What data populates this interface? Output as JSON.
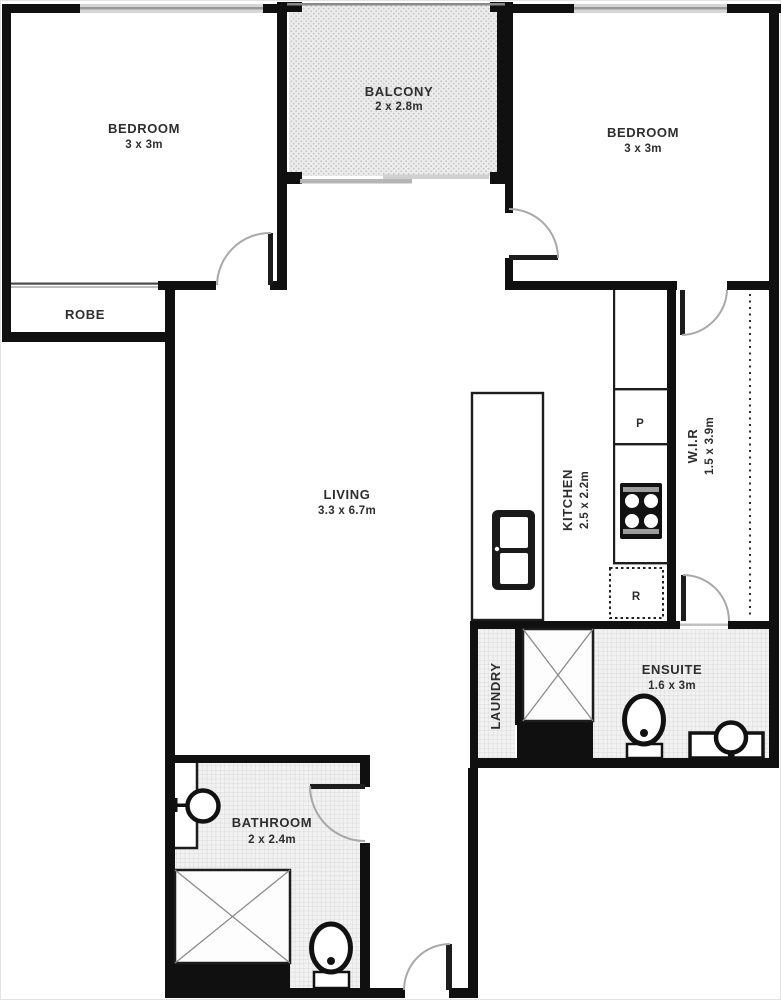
{
  "rooms": {
    "bedroom_left": {
      "name": "BEDROOM",
      "dims": "3 x 3m"
    },
    "bedroom_right": {
      "name": "BEDROOM",
      "dims": "3 x 3m"
    },
    "balcony": {
      "name": "BALCONY",
      "dims": "2 x 2.8m"
    },
    "robe": {
      "name": "ROBE"
    },
    "living": {
      "name": "LIVING",
      "dims": "3.3 x 6.7m"
    },
    "kitchen": {
      "name": "KITCHEN",
      "dims": "2.5 x 2.2m"
    },
    "wir": {
      "name": "W.I.R",
      "dims": "1.5 x 3.9m"
    },
    "laundry": {
      "name": "LAUNDRY"
    },
    "ensuite": {
      "name": "ENSUITE",
      "dims": "1.6 x 3m"
    },
    "bathroom": {
      "name": "BATHROOM",
      "dims": "2 x 2.4m"
    }
  },
  "markers": {
    "pantry": "P",
    "fridge": "R"
  },
  "colors": {
    "wall": "#101010",
    "hatch_bg": "#f2f2f2",
    "hatch_line": "#d9d9d9",
    "balcony_bg": "#ececec",
    "balcony_dot": "#c6c6c6",
    "door_arc": "#a8a8a8",
    "window": "#d6d6d6"
  }
}
